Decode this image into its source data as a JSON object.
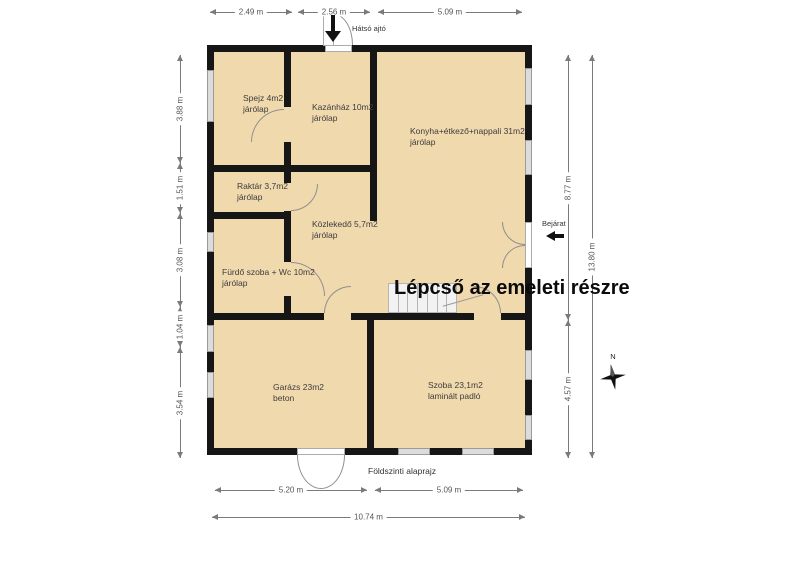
{
  "plan_title": "Földszinti alaprajz",
  "overlay_text": "Lépcső az emeleti részre",
  "annotations": {
    "back_door": "Hátsó ajtó",
    "entrance": "Bejárat"
  },
  "compass": {
    "north": "N"
  },
  "rooms": {
    "spejz": {
      "name": "Spejz 4m2",
      "floor": "járólap"
    },
    "kazanhaz": {
      "name": "Kazánház 10m2",
      "floor": "járólap"
    },
    "konyha": {
      "name": "Konyha+étkező+nappali 31m2",
      "floor": "járólap"
    },
    "raktar": {
      "name": "Raktár 3,7m2",
      "floor": "járólap"
    },
    "kozlekedo": {
      "name": "Közlekedő 5,7m2",
      "floor": "járólap"
    },
    "furdo": {
      "name": "Fürdő szoba + Wc 10m2",
      "floor": "járólap"
    },
    "garazs": {
      "name": "Garázs 23m2",
      "floor": "beton"
    },
    "szoba": {
      "name": "Szoba 23,1m2",
      "floor": "laminált padló"
    }
  },
  "dimensions": {
    "top": [
      "2.49 m",
      "2.56 m",
      "5.09 m"
    ],
    "left": [
      "3.88 m",
      "1.51 m",
      "3.08 m",
      "1.04 m",
      "3.54 m"
    ],
    "right_inner": [
      "8.77 m",
      "4.57 m"
    ],
    "right_outer": "13.80 m",
    "bottom_inner": [
      "5.20 m",
      "5.09 m"
    ],
    "bottom_outer": "10.74 m"
  },
  "colors": {
    "room_fill": "#f1d9ae",
    "wall": "#161616",
    "window_fill": "#dcdcdc",
    "dim_color": "#7a7a7a",
    "arc_color": "#8f8f8f",
    "label_color": "#3c3c3c",
    "overlay_text_color": "#0b0b0b"
  }
}
